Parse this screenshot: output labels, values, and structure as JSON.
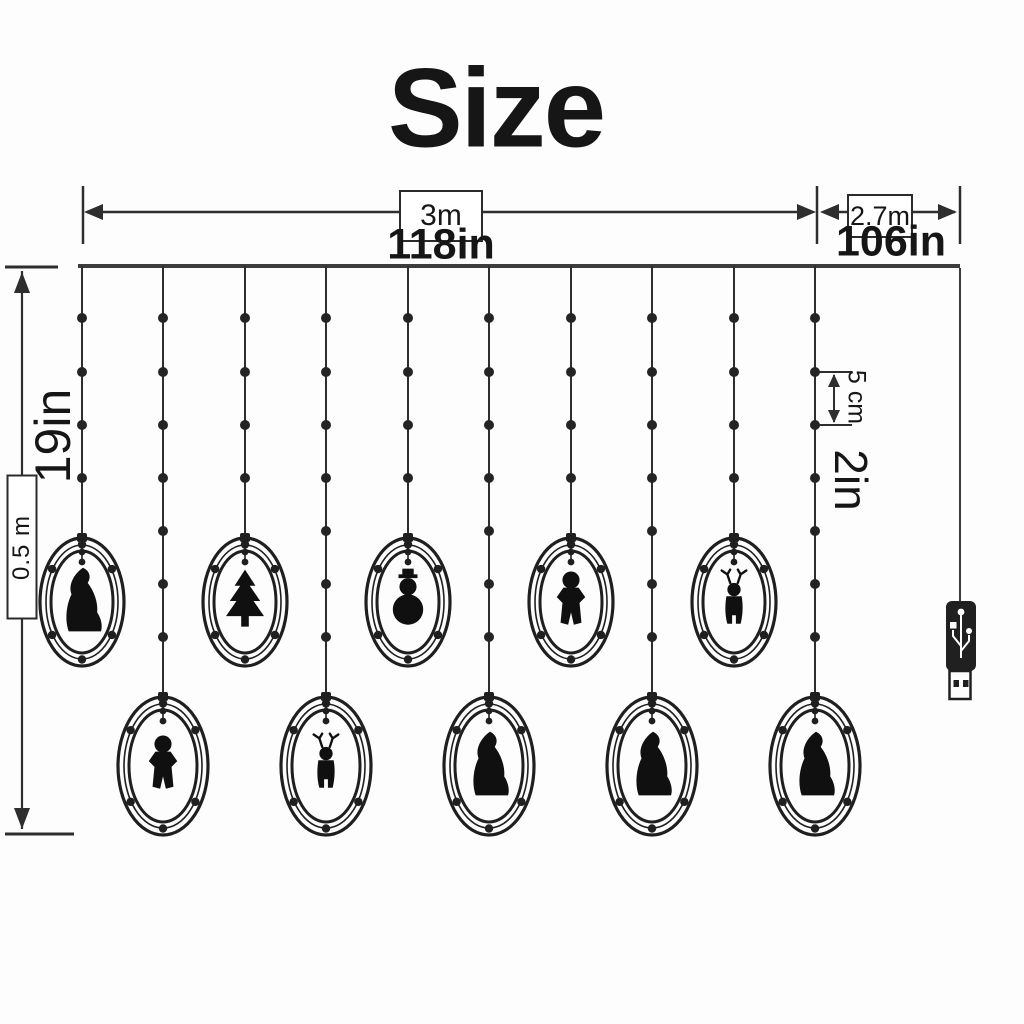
{
  "title": "Size",
  "dimension_labels": {
    "curtain_width_metric": "3m",
    "curtain_width_imperial": "118in",
    "lead_wire_metric": "2.7m",
    "lead_wire_imperial": "106in",
    "drop_height_imperial": "19in",
    "drop_height_metric": "0.5 m",
    "bulb_spacing_metric": "5 cm",
    "bulb_spacing_imperial": "2in"
  },
  "diagram": {
    "string_count": 10,
    "ring_count": 10,
    "strings": [
      {
        "index": 1,
        "length": "short",
        "figure": "santa"
      },
      {
        "index": 2,
        "length": "long",
        "figure": "gingerbread"
      },
      {
        "index": 3,
        "length": "short",
        "figure": "tree"
      },
      {
        "index": 4,
        "length": "long",
        "figure": "reindeer"
      },
      {
        "index": 5,
        "length": "short",
        "figure": "snowman"
      },
      {
        "index": 6,
        "length": "long",
        "figure": "santa"
      },
      {
        "index": 7,
        "length": "short",
        "figure": "gingerbread"
      },
      {
        "index": 8,
        "length": "long",
        "figure": "santa"
      },
      {
        "index": 9,
        "short_note": "",
        "length": "short",
        "figure": "reindeer"
      },
      {
        "index": 10,
        "length": "long",
        "figure": "santa"
      }
    ],
    "figure_types": [
      "santa",
      "gingerbread",
      "tree",
      "reindeer",
      "snowman"
    ],
    "connector": "usb-plug"
  },
  "colors": {
    "ink": "#1f1f1f",
    "line": "#2e2e2e",
    "rail": "#3d3d3d",
    "background": "#fdfdfd"
  }
}
